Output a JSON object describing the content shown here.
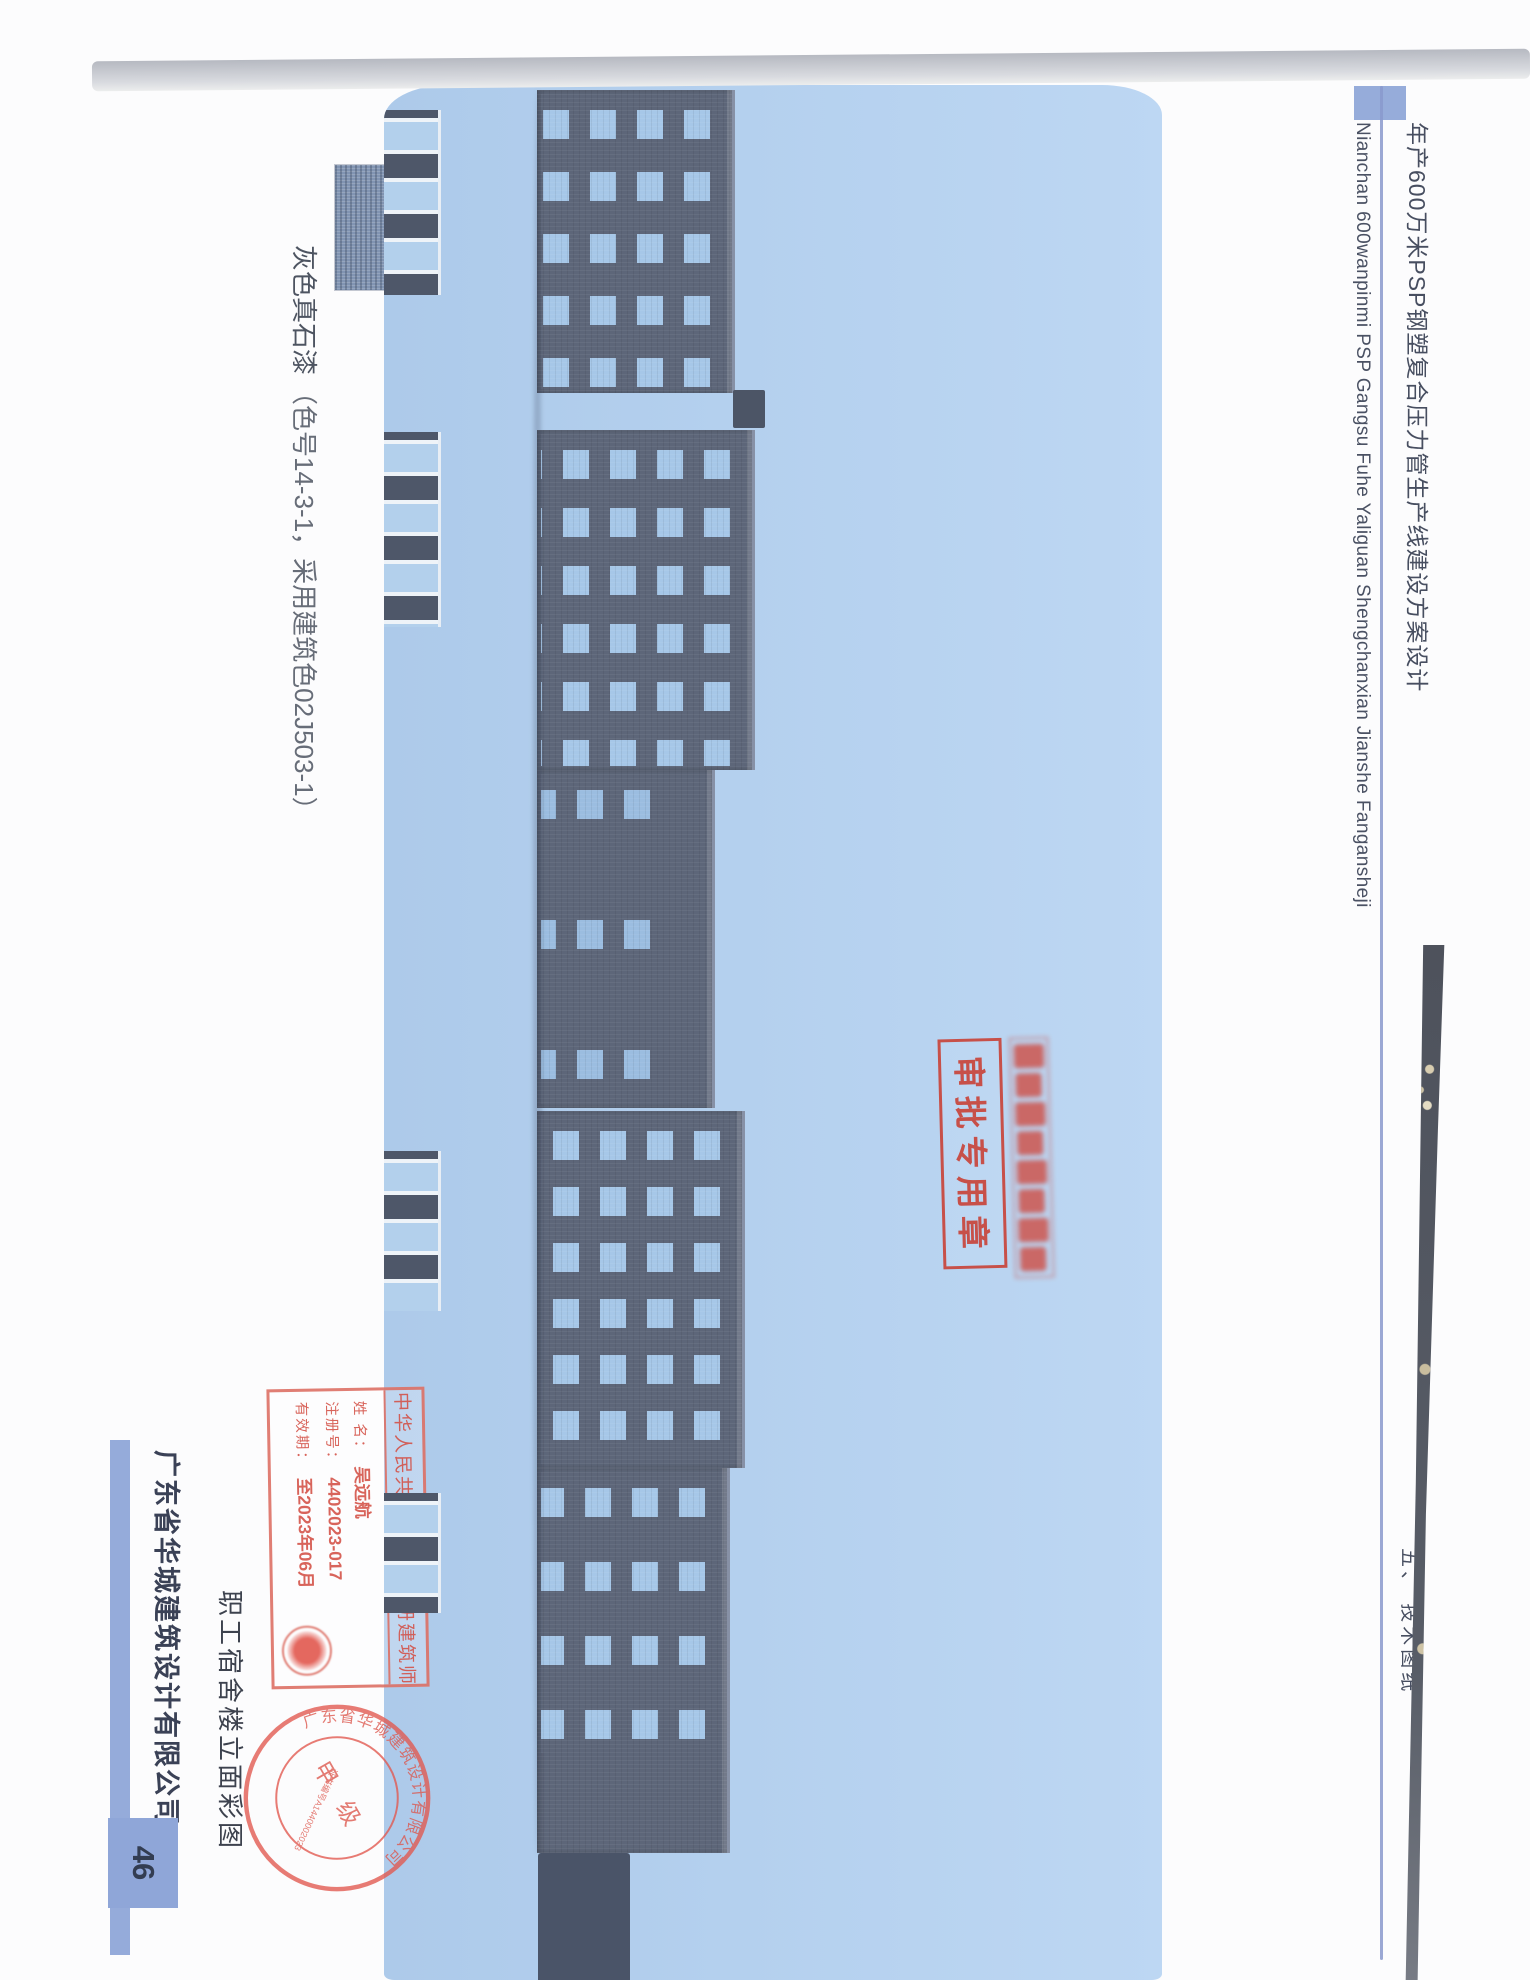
{
  "header": {
    "project_title": "年产600万米PSP钢塑复合压力管生产线建设方案设计",
    "project_title_pinyin": "Nianchan  600wanpinmi  PSP   Gangsu  Fuhe  Yaliguan   Shengchanxian   Jianshe   Fangansheji",
    "section_label": "五、 技术图纸"
  },
  "legend": {
    "material_label": "灰色真石漆",
    "spec_label": "（色号14-3-1，采用建筑色02J503-1）"
  },
  "figure": {
    "caption": "职工宿舍楼立面彩图"
  },
  "stamps": {
    "approval": {
      "label": "审批专用章"
    },
    "architect": {
      "title": "中华人民共和国一级注册建筑师",
      "name_label": "姓  名：",
      "name_value": "吴远航",
      "reg_label": "注册号：",
      "reg_value": "4402023-017",
      "valid_label": "有效期：",
      "valid_value": "至2023年06月"
    },
    "company_seal": {
      "ring_text": "广东省华城建筑设计有限公司",
      "grade_text": "甲 级",
      "cert_text": "证书编号A1440002023"
    }
  },
  "footer": {
    "company_name": "广东省华城建筑设计有限公司",
    "page_number": "46"
  },
  "colors": {
    "sky": "#b7d2f0",
    "wall": "#5d6679",
    "window": "#a6c7e8",
    "stamp_red": "#c9453b",
    "accent_blue": "#8fa6d8",
    "header_rule_blue": "#8a99cc"
  }
}
